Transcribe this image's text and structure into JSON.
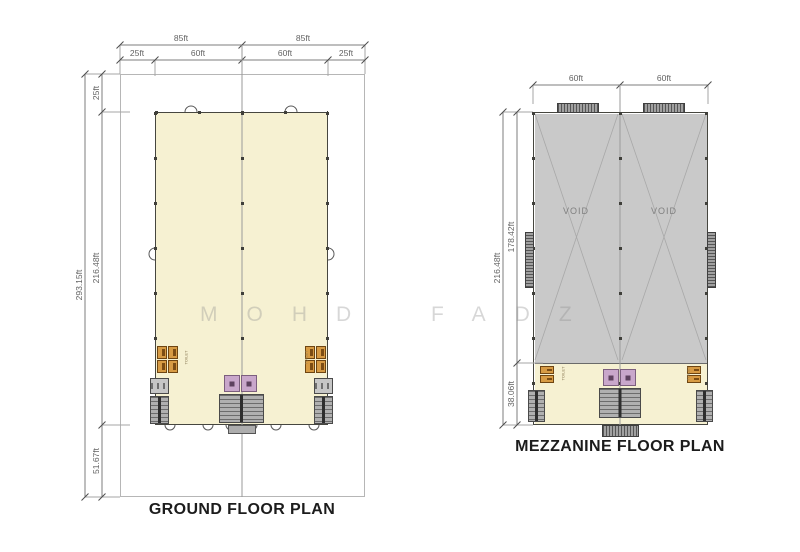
{
  "watermark_text": "MOHD FADZ",
  "ground_plan": {
    "title": "GROUND FLOOR PLAN",
    "dimensions": {
      "top_row1": [
        "85ft",
        "85ft"
      ],
      "top_row2": [
        "25ft",
        "60ft",
        "60ft",
        "25ft"
      ],
      "left_total": "293.15ft",
      "left_segments": [
        "25ft",
        "216.48ft",
        "51.67ft"
      ]
    },
    "rooms": {
      "toilet_left": "TOILET",
      "toilet_right": "TOILET"
    }
  },
  "mezzanine_plan": {
    "title": "MEZZANINE FLOOR PLAN",
    "dimensions": {
      "top_row": [
        "60ft",
        "60ft"
      ],
      "left_total": "216.48ft",
      "left_segments": [
        "178.42ft",
        "38.06ft"
      ]
    },
    "rooms": {
      "void_left": "VOID",
      "void_right": "VOID",
      "toilet_left": "TOILET",
      "toilet_right": "TOILET"
    }
  },
  "colors": {
    "floor_fill": "#f6f1d2",
    "void_fill": "#c9c9c9",
    "lift_fill": "#c9a7cb",
    "toilet_fixture": "#d79b44",
    "stair_fill": "#b0b0b0",
    "dimension_line": "#7d7d7d",
    "title_text": "#1c1c1c"
  }
}
